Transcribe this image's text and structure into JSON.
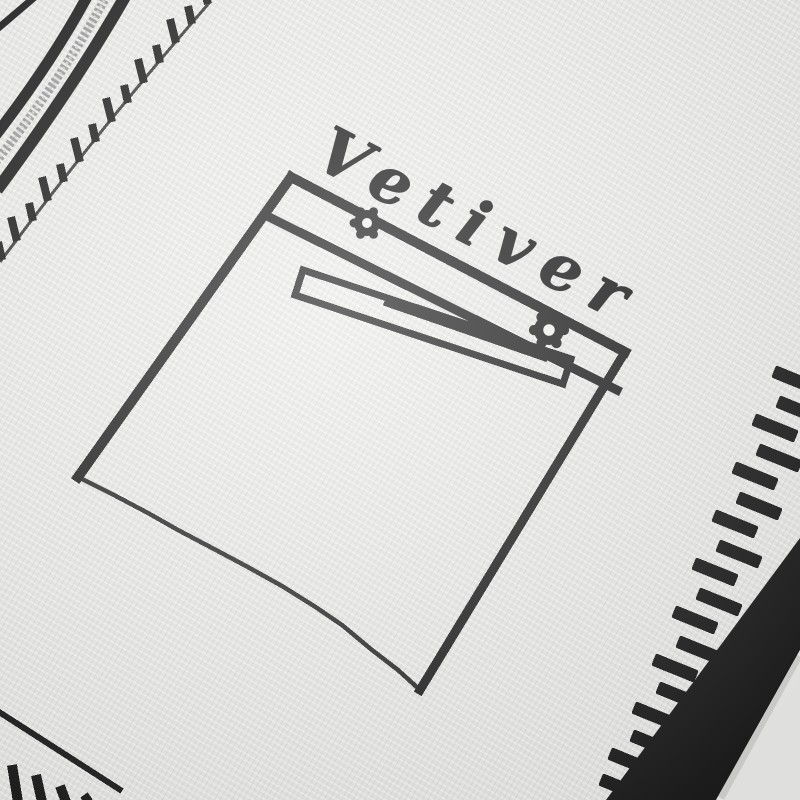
{
  "photo": {
    "alt": "Close-up of a white knitted garment with black trompe-l'oeil details: a real zipper at top left, knitted fringe stitch marks, a drawn chest pocket with two rivet buttons and a welt slot, cursive knitted script above the pocket, and ribbed dashed borders along the right and bottom edges",
    "script_text": "Vetiver",
    "colors": {
      "ink_black": "#1c1c1c",
      "knit_white": "#f3f3f1",
      "zipper_silver": "#9b9b9b",
      "zipper_highlight": "#d2d2d2",
      "background_gray": "#e9e9e8"
    }
  }
}
